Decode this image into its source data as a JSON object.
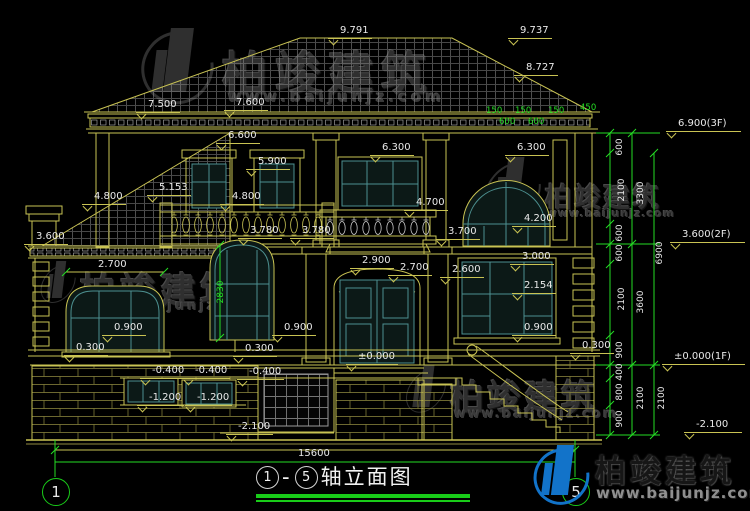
{
  "title": {
    "from": "1",
    "dash": "-",
    "to": "5",
    "name": "轴立面图"
  },
  "axis": {
    "left": "1",
    "right": "5"
  },
  "brand": {
    "name": "柏竣建筑",
    "url": "www.baijunjz.com"
  },
  "annotations": [
    {
      "t": "9.791",
      "x": 328,
      "y": 25,
      "k": "lvl"
    },
    {
      "t": "9.737",
      "x": 508,
      "y": 25,
      "k": "lvl"
    },
    {
      "t": "8.727",
      "x": 514,
      "y": 62,
      "k": "lvl"
    },
    {
      "t": "7.500",
      "x": 136,
      "y": 99,
      "k": "lvl"
    },
    {
      "t": "7.600",
      "x": 224,
      "y": 97,
      "k": "lvl"
    },
    {
      "t": "6.600",
      "x": 216,
      "y": 130,
      "k": "lvl"
    },
    {
      "t": "6.300",
      "x": 370,
      "y": 142,
      "k": "lvl"
    },
    {
      "t": "6.300",
      "x": 505,
      "y": 142,
      "k": "lvl"
    },
    {
      "t": "5.900",
      "x": 246,
      "y": 156,
      "k": "lvl"
    },
    {
      "t": "5.153",
      "x": 147,
      "y": 182,
      "k": "lvl"
    },
    {
      "t": "4.800",
      "x": 82,
      "y": 191,
      "k": "lvl"
    },
    {
      "t": "4.800",
      "x": 220,
      "y": 191,
      "k": "lvl"
    },
    {
      "t": "4.700",
      "x": 404,
      "y": 197,
      "k": "lvl"
    },
    {
      "t": "4.200",
      "x": 512,
      "y": 213,
      "k": "lvl"
    },
    {
      "t": "3.780",
      "x": 238,
      "y": 225,
      "k": "lvl"
    },
    {
      "t": "3.780",
      "x": 290,
      "y": 225,
      "k": "lvl"
    },
    {
      "t": "3.700",
      "x": 436,
      "y": 226,
      "k": "lvl"
    },
    {
      "t": "3.600",
      "x": 24,
      "y": 231,
      "k": "lvl"
    },
    {
      "t": "3.000",
      "x": 510,
      "y": 251,
      "k": "lvl"
    },
    {
      "t": "2.900",
      "x": 350,
      "y": 255,
      "k": "lvl"
    },
    {
      "t": "2.700",
      "x": 388,
      "y": 262,
      "k": "lvl"
    },
    {
      "t": "2.600",
      "x": 440,
      "y": 264,
      "k": "lvl"
    },
    {
      "t": "2.154",
      "x": 512,
      "y": 280,
      "k": "lvl"
    },
    {
      "t": "0.900",
      "x": 102,
      "y": 322,
      "k": "lvl"
    },
    {
      "t": "0.900",
      "x": 272,
      "y": 322,
      "k": "lvl"
    },
    {
      "t": "0.900",
      "x": 512,
      "y": 322,
      "k": "lvl"
    },
    {
      "t": "0.300",
      "x": 64,
      "y": 342,
      "k": "lvl"
    },
    {
      "t": "0.300",
      "x": 233,
      "y": 343,
      "k": "lvl"
    },
    {
      "t": "0.300",
      "x": 570,
      "y": 340,
      "k": "lvl"
    },
    {
      "t": "±0.000",
      "x": 346,
      "y": 351,
      "k": "lvl"
    },
    {
      "t": "-0.400",
      "x": 140,
      "y": 365,
      "k": "lvl"
    },
    {
      "t": "-0.400",
      "x": 183,
      "y": 365,
      "k": "lvl"
    },
    {
      "t": "-0.400",
      "x": 237,
      "y": 366,
      "k": "lvl"
    },
    {
      "t": "-1.200",
      "x": 137,
      "y": 392,
      "k": "lvl"
    },
    {
      "t": "-1.200",
      "x": 185,
      "y": 392,
      "k": "lvl"
    },
    {
      "t": "-2.100",
      "x": 226,
      "y": 421,
      "k": "lvl"
    },
    {
      "t": "6.900(3F)",
      "x": 666,
      "y": 118,
      "k": "lvlr"
    },
    {
      "t": "3.600(2F)",
      "x": 670,
      "y": 229,
      "k": "lvlr"
    },
    {
      "t": "±0.000(1F)",
      "x": 662,
      "y": 351,
      "k": "lvlr"
    },
    {
      "t": "-2.100",
      "x": 684,
      "y": 419,
      "k": "lvlr"
    },
    {
      "t": "2.700",
      "x": 98,
      "y": 259,
      "k": "dim"
    },
    {
      "t": "15600",
      "x": 298,
      "y": 448,
      "k": "dim"
    },
    {
      "t": "150",
      "x": 486,
      "y": 107,
      "k": "grn"
    },
    {
      "t": "150",
      "x": 515,
      "y": 107,
      "k": "grn"
    },
    {
      "t": "150",
      "x": 548,
      "y": 107,
      "k": "grn"
    },
    {
      "t": "450",
      "x": 580,
      "y": 104,
      "k": "grn"
    },
    {
      "t": "600",
      "x": 499,
      "y": 118,
      "k": "grn"
    },
    {
      "t": "600",
      "x": 528,
      "y": 118,
      "k": "grn"
    },
    {
      "t": "600",
      "x": 620,
      "y": 147,
      "k": "v"
    },
    {
      "t": "2100",
      "x": 622,
      "y": 190,
      "k": "v"
    },
    {
      "t": "3300",
      "x": 641,
      "y": 193,
      "k": "v"
    },
    {
      "t": "600",
      "x": 620,
      "y": 233,
      "k": "v"
    },
    {
      "t": "600",
      "x": 620,
      "y": 253,
      "k": "v"
    },
    {
      "t": "6900",
      "x": 660,
      "y": 253,
      "k": "v"
    },
    {
      "t": "2100",
      "x": 622,
      "y": 299,
      "k": "v"
    },
    {
      "t": "3600",
      "x": 641,
      "y": 302,
      "k": "v"
    },
    {
      "t": "900",
      "x": 620,
      "y": 350,
      "k": "v"
    },
    {
      "t": "400",
      "x": 620,
      "y": 372,
      "k": "v"
    },
    {
      "t": "800",
      "x": 620,
      "y": 392,
      "k": "v"
    },
    {
      "t": "2100",
      "x": 641,
      "y": 398,
      "k": "v"
    },
    {
      "t": "2100",
      "x": 662,
      "y": 398,
      "k": "v"
    },
    {
      "t": "900",
      "x": 620,
      "y": 419,
      "k": "v"
    },
    {
      "t": "2830",
      "x": 221,
      "y": 292,
      "k": "vg"
    }
  ]
}
